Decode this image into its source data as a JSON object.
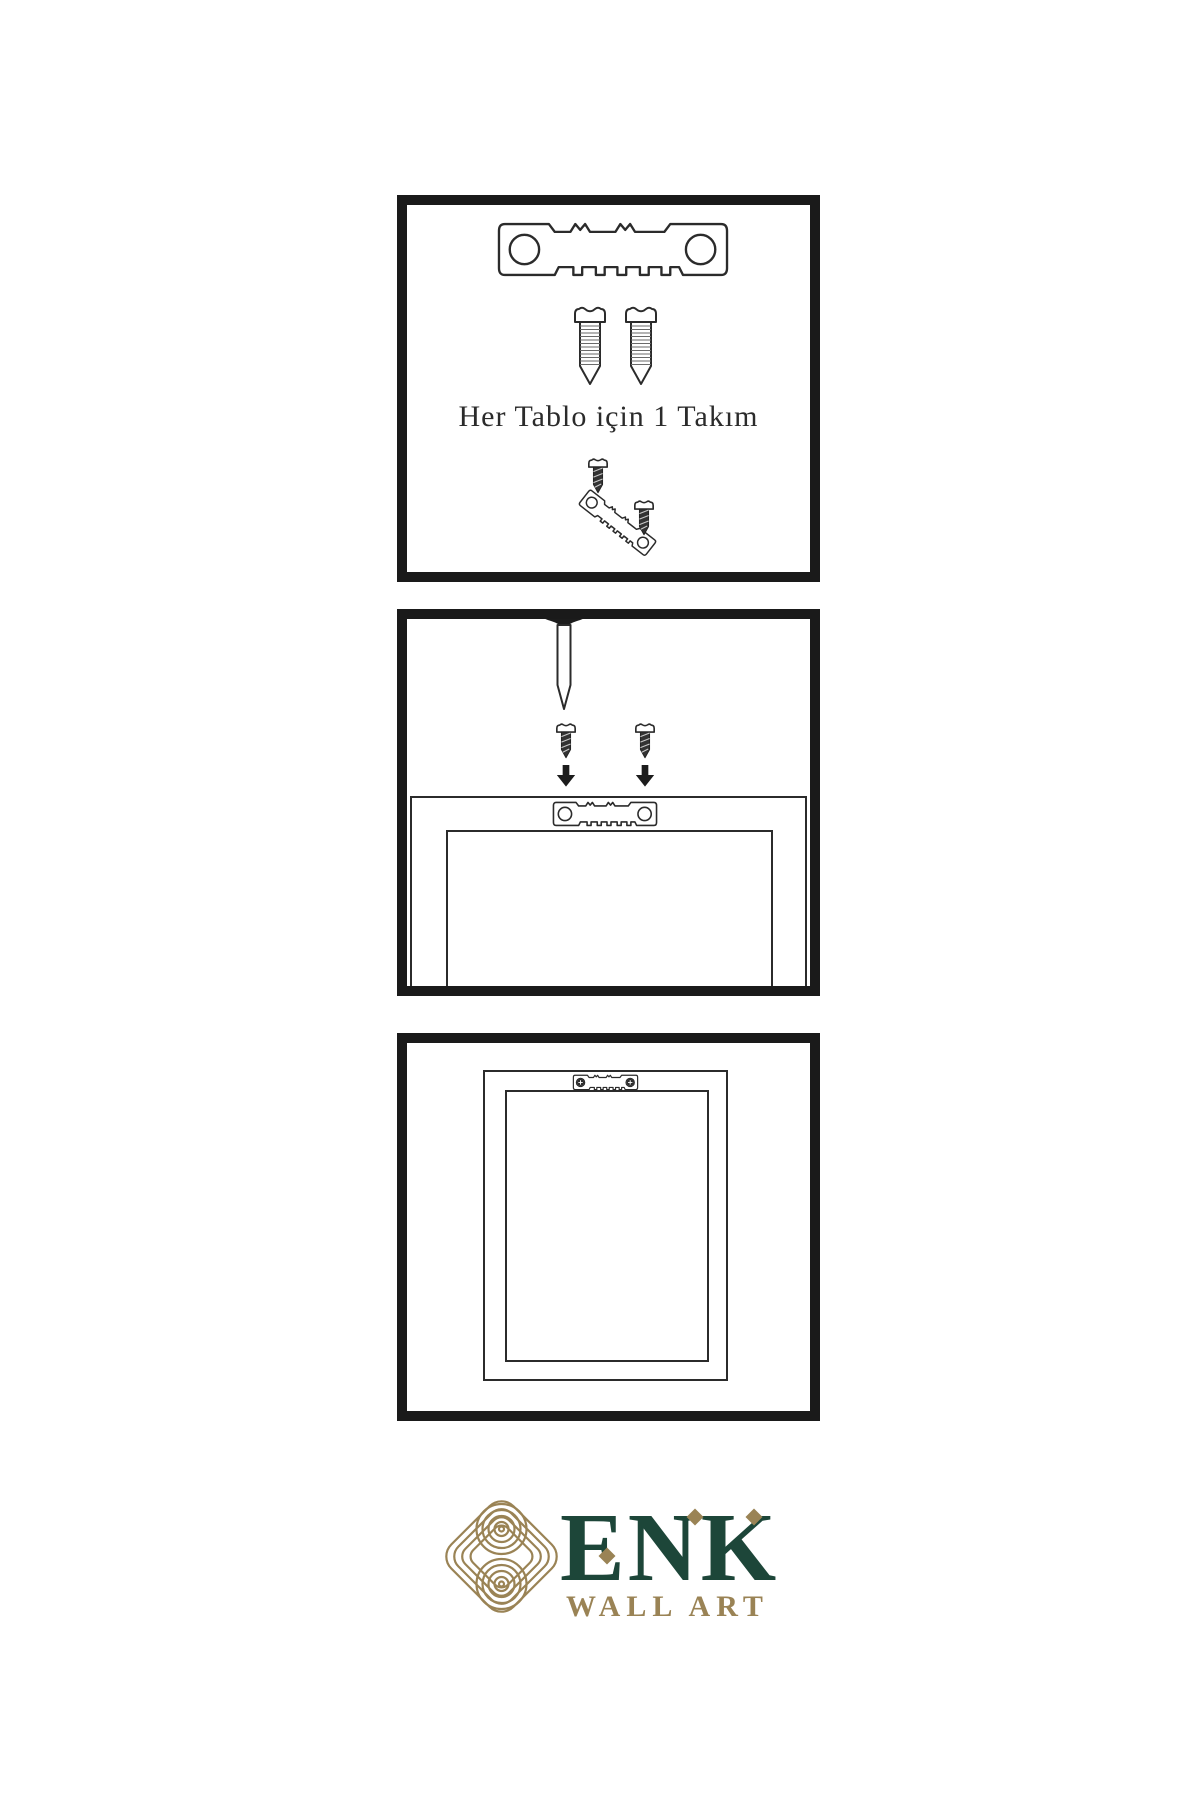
{
  "step1": {
    "caption": "Her Tablo için 1 Takım"
  },
  "brand": {
    "name": "ENK",
    "tagline": "WALL ART"
  },
  "colors": {
    "ink": "#1a1a1a",
    "line": "#2b2b2b",
    "brand_green": "#1d4639",
    "brand_gold": "#9a8355",
    "background": "#ffffff"
  },
  "icons": {
    "sawtooth-hanger-icon": "sawtooth picture hanger bar with two screw holes",
    "screw-icon": "threaded screw, side view",
    "dark-screw-icon": "small dark screw",
    "arrow-down-icon": "solid downward arrow",
    "nail-icon": "wall nail driven from top",
    "frame-back-icon": "back of picture frame",
    "mounted-hanger-icon": "sawtooth hanger fixed with two screws",
    "knot-logo-icon": "interlaced knot brand emblem"
  }
}
